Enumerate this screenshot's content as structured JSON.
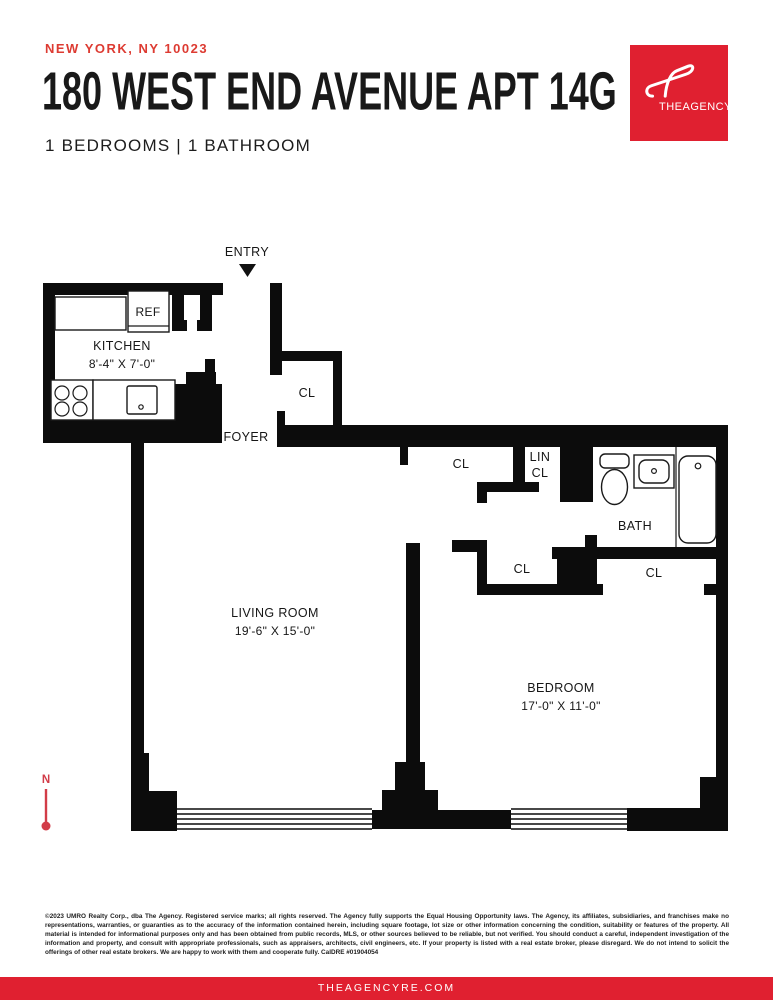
{
  "header": {
    "location": "NEW YORK, NY 10023",
    "title": "180 WEST END AVENUE APT 14G",
    "subtitle": "1 BEDROOMS | 1 BATHROOM"
  },
  "logo": {
    "brand": "THEAGENCY"
  },
  "plan": {
    "entry_label": "ENTRY",
    "foyer_label": "FOYER",
    "kitchen": {
      "name": "KITCHEN",
      "dims": "8'-4\" X 7'-0\"",
      "fridge": "REF"
    },
    "living_room": {
      "name": "LIVING ROOM",
      "dims": "19'-6\" X 15'-0\""
    },
    "bedroom": {
      "name": "BEDROOM",
      "dims": "17'-0\" X 11'-0\""
    },
    "bath": {
      "name": "BATH"
    },
    "closets": {
      "foyer_closet": "CL",
      "hall_closet": "CL",
      "linen_line1": "LIN",
      "linen_line2": "CL",
      "bedroom_closet": "CL",
      "bedroom_closet_east": "CL"
    },
    "compass": {
      "north": "N"
    }
  },
  "footer": {
    "disclaimer": "©2023 UMRO Realty Corp., dba The Agency. Registered service marks; all rights reserved. The Agency fully supports the Equal Housing Opportunity laws. The Agency, its affiliates, subsidiaries, and franchises make no representations, warranties, or guaranties as to the accuracy of the information contained herein, including square footage, lot size or other information concerning the condition, suitability or features of the property. All material is intended for informational purposes only and has been obtained from public records, MLS, or other sources believed to be reliable, but not verified. You should conduct a careful, independent investigation of the information and property, and consult with appropriate professionals, such as appraisers, architects, civil engineers, etc. If your property is listed with a real estate broker, please disregard. We do not intend to solicit the offerings of other real estate brokers. We are happy to work with them and cooperate fully. CalDRE #01904054",
    "website": "THEAGENCYRE.COM"
  },
  "colors": {
    "brand_red": "#e02030",
    "location_red": "#dd3b32",
    "compass_red": "#d23c48",
    "wall_black": "#0c0c0c"
  }
}
